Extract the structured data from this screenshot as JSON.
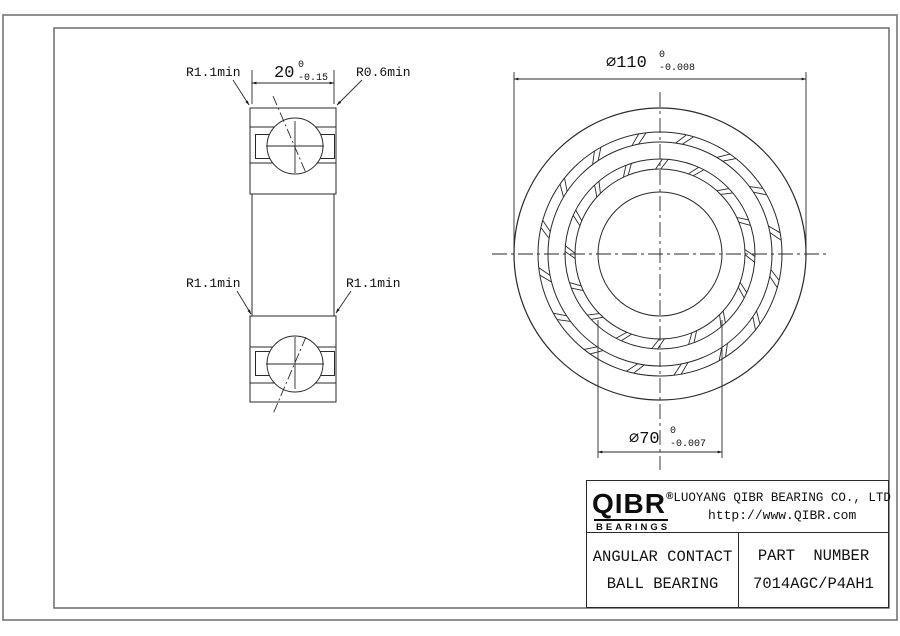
{
  "sheet": {
    "colors": {
      "line": "#2a2a2a",
      "border": "#757575",
      "text": "#111111",
      "background": "#ffffff"
    }
  },
  "annotations": {
    "radius_top_left": "R1.1min",
    "radius_top_right": "R0.6min",
    "radius_mid_left": "R1.1min",
    "radius_mid_right": "R1.1min",
    "width_dim": {
      "value": "20",
      "tol_upper": "0",
      "tol_lower": "-0.15"
    },
    "outer_diameter_dim": {
      "value": "⌀110",
      "tol_upper": "0",
      "tol_lower": "-0.008"
    },
    "bore_diameter_dim": {
      "value": "⌀70",
      "tol_upper": "0",
      "tol_lower": "-0.007"
    }
  },
  "title_block": {
    "logo_name": "QIBR",
    "logo_registered": "®",
    "logo_subtitle": "BEARINGS",
    "company_name": "LUOYANG QIBR BEARING CO., LTD",
    "website": "http://www.QIBR.com",
    "product_line1": "ANGULAR CONTACT",
    "product_line2": "BALL BEARING",
    "part_number_label": "PART NUMBER",
    "part_number_value": "7014AGC/P4AH1"
  }
}
